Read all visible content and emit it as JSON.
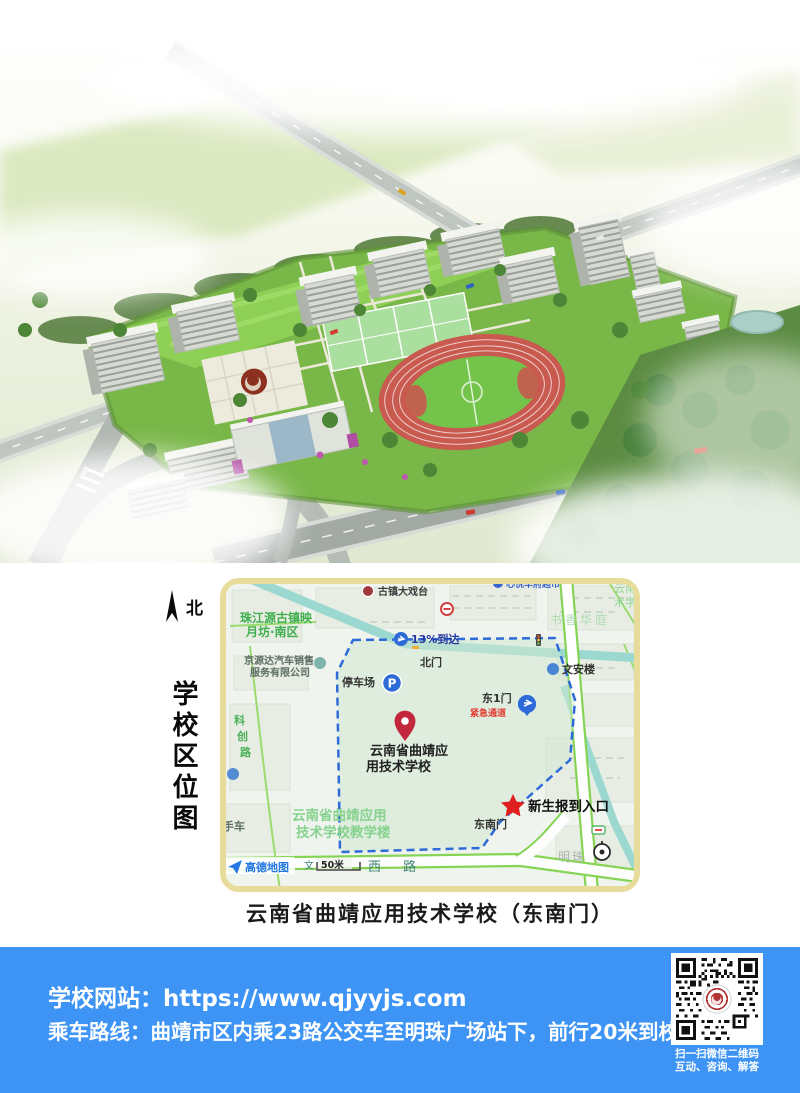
{
  "colors": {
    "footer_bg": "#3d94f5",
    "map_frame": "#e7dc9c",
    "boundary_blue": "#2e6bd8",
    "star_red": "#e02020",
    "pin_red": "#c2273d",
    "amap_blue": "#2577e3"
  },
  "side": {
    "north": "北",
    "vertical_title": "学校区位图"
  },
  "map": {
    "caption": "云南省曲靖应用技术学校（东南门）",
    "labels": {
      "theater": "古镇大戏台",
      "residence_1": "珠江源古镇映",
      "residence_2": "月坊·南区",
      "estate": "书香华庭",
      "supermarket": "心悦华府超市",
      "corner_1": "云南",
      "corner_2": "术学",
      "arrival": "13%到达",
      "dealer_1": "京源达汽车销售",
      "dealer_2": "服务有限公司",
      "north_gate": "北门",
      "wenan_tower": "文安楼",
      "parking": "停车场",
      "parking_glyph": "P",
      "east1_gate": "东1门",
      "emergency": "紧急通道",
      "school_1": "云南省曲靖应",
      "school_2": "用技术学校",
      "kechuang_1": "科",
      "kechuang_2": "创",
      "kechuang_3": "路",
      "teaching_1": "云南省曲靖应用",
      "teaching_2": "技术学校教学楼",
      "used_car": "二手车",
      "southeast_gate": "东南门",
      "report_entrance": "新生报到入口",
      "mingzhu": "明珠",
      "amap": "高德地图",
      "road_char": "文",
      "scale": "50米",
      "west_road": "西 路"
    }
  },
  "footer": {
    "website": "学校网站：https://www.qjyyjs.com",
    "route": "乘车路线：曲靖市区内乘23路公交车至明珠广场站下，前行20米到校",
    "qr_caption_1": "扫一扫微信二维码",
    "qr_caption_2": "互动、咨询、解答"
  }
}
